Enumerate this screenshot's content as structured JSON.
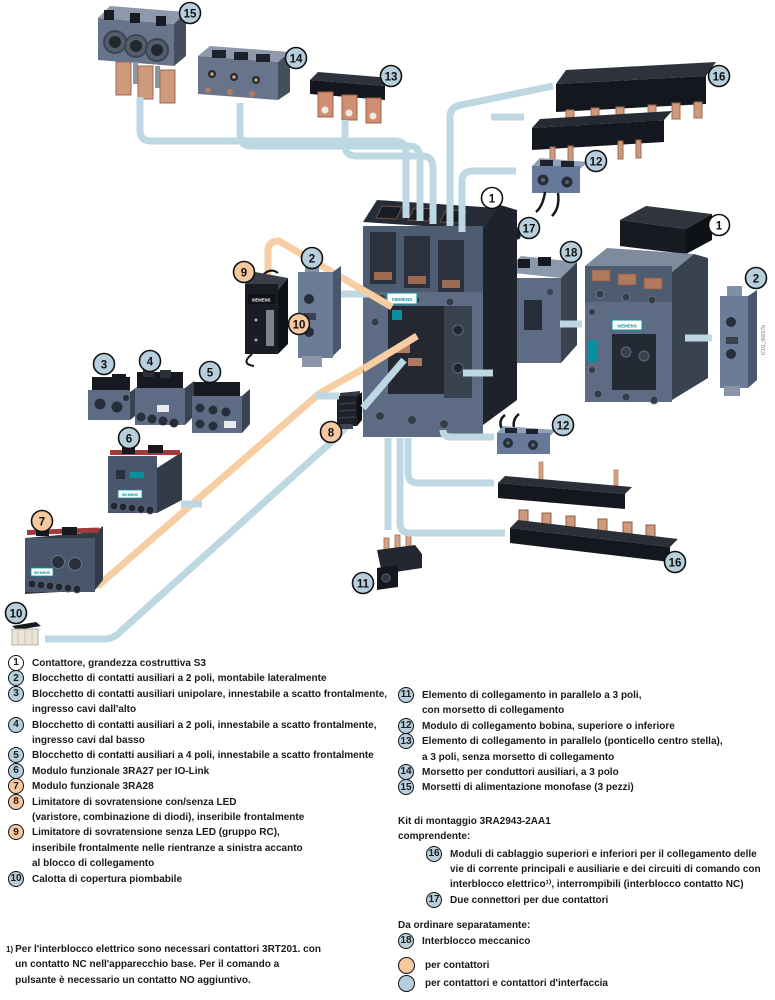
{
  "diagram": {
    "brand_label": "SIEMENS",
    "watermark": "IC01_00017b",
    "callout_colors": {
      "blue": "#b7cedd",
      "peach": "#f5c8a0",
      "white": "#ffffff"
    },
    "callouts": [
      {
        "n": "15",
        "color": "blue",
        "x": 190,
        "y": 13
      },
      {
        "n": "14",
        "color": "blue",
        "x": 296,
        "y": 58
      },
      {
        "n": "13",
        "color": "blue",
        "x": 391,
        "y": 76
      },
      {
        "n": "16",
        "color": "blue",
        "x": 719,
        "y": 76
      },
      {
        "n": "12",
        "color": "blue",
        "x": 596,
        "y": 161
      },
      {
        "n": "1",
        "color": "white",
        "x": 492,
        "y": 198
      },
      {
        "n": "17",
        "color": "blue",
        "x": 529,
        "y": 228
      },
      {
        "n": "18",
        "color": "blue",
        "x": 571,
        "y": 252
      },
      {
        "n": "1",
        "color": "white",
        "x": 719,
        "y": 225
      },
      {
        "n": "2",
        "color": "blue",
        "x": 756,
        "y": 278
      },
      {
        "n": "9",
        "color": "peach",
        "x": 244,
        "y": 272
      },
      {
        "n": "2",
        "color": "blue",
        "x": 312,
        "y": 258
      },
      {
        "n": "10",
        "color": "peach",
        "x": 299,
        "y": 324
      },
      {
        "n": "3",
        "color": "blue",
        "x": 104,
        "y": 364
      },
      {
        "n": "4",
        "color": "blue",
        "x": 150,
        "y": 361
      },
      {
        "n": "5",
        "color": "blue",
        "x": 210,
        "y": 372
      },
      {
        "n": "6",
        "color": "blue",
        "x": 129,
        "y": 438
      },
      {
        "n": "7",
        "color": "peach",
        "x": 42,
        "y": 521
      },
      {
        "n": "8",
        "color": "peach",
        "x": 331,
        "y": 432
      },
      {
        "n": "10",
        "color": "blue",
        "x": 16,
        "y": 613
      },
      {
        "n": "11",
        "color": "blue",
        "x": 363,
        "y": 583
      },
      {
        "n": "12",
        "color": "blue",
        "x": 563,
        "y": 425
      },
      {
        "n": "16",
        "color": "blue",
        "x": 675,
        "y": 562
      }
    ]
  },
  "legend": {
    "left_items": [
      {
        "num": "1",
        "color": "white",
        "text": "Contattore, grandezza costruttiva S3"
      },
      {
        "num": "2",
        "color": "blue",
        "text": "Blocchetto di contatti ausiliari a 2 poli, montabile lateralmente"
      },
      {
        "num": "3",
        "color": "blue",
        "text": "Blocchetto di contatti ausiliari unipolare, innestabile a scatto frontalmente,\ningresso cavi dall'alto"
      },
      {
        "num": "4",
        "color": "blue",
        "text": "Blocchetto di contatti ausiliari a 2 poli, innestabile a scatto frontalmente,\ningresso cavi dal basso"
      },
      {
        "num": "5",
        "color": "blue",
        "text": "Blocchetto di contatti ausiliari a 4 poli, innestabile a scatto frontalmente"
      },
      {
        "num": "6",
        "color": "blue",
        "text": "Modulo funzionale 3RA27 per IO-Link"
      },
      {
        "num": "7",
        "color": "peach",
        "text": "Modulo funzionale 3RA28"
      },
      {
        "num": "8",
        "color": "peach",
        "text": "Limitatore di sovratensione con/senza LED\n(varistore, combinazione di diodi), inseribile frontalmente"
      },
      {
        "num": "9",
        "color": "peach",
        "text": "Limitatore di sovratensione senza LED (gruppo RC),\ninseribile frontalmente nelle rientranze a sinistra accanto\nal blocco di collegamento"
      },
      {
        "num": "10",
        "color": "blue",
        "text": "Calotta di copertura piombabile"
      }
    ],
    "right_items": [
      {
        "num": "11",
        "color": "blue",
        "text": "Elemento di collegamento in parallelo a 3 poli,\ncon morsetto di collegamento"
      },
      {
        "num": "12",
        "color": "blue",
        "text": "Modulo di collegamento bobina, superiore o inferiore"
      },
      {
        "num": "13",
        "color": "blue",
        "text": "Elemento di collegamento in parallelo (ponticello centro stella),\na 3 poli, senza morsetto di collegamento"
      },
      {
        "num": "14",
        "color": "blue",
        "text": "Morsetto per conduttori ausiliari, a 3 polo"
      },
      {
        "num": "15",
        "color": "blue",
        "text": "Morsetti di alimentazione monofase (3 pezzi)"
      }
    ],
    "kit": {
      "title": "Kit di montaggio 3RA2943-2AA1",
      "subtitle": "comprendente:",
      "items": [
        {
          "num": "16",
          "color": "blue",
          "text": "Moduli di cablaggio superiori e inferiori per il collegamento delle\nvie di corrente principali e ausiliarie e dei circuiti di comando con\ninterblocco elettrico¹⁾, interrompibili (interblocco contatto NC)"
        },
        {
          "num": "17",
          "color": "blue",
          "text": "Due connettori per due contattori"
        }
      ]
    },
    "separate": {
      "title": "Da ordinare separatamente:",
      "items": [
        {
          "num": "18",
          "color": "blue",
          "text": "Interblocco meccanico"
        }
      ]
    },
    "color_key": [
      {
        "color": "peach",
        "label": "per contattori"
      },
      {
        "color": "blue",
        "label": "per contattori e contattori d'interfaccia"
      }
    ],
    "footnote": {
      "marker": "1)",
      "text": "Per l'interblocco elettrico sono necessari contattori 3RT201. con\nun contatto NC nell'apparecchio base. Per il comando a\npulsante è necessario un contatto NO aggiuntivo."
    }
  }
}
